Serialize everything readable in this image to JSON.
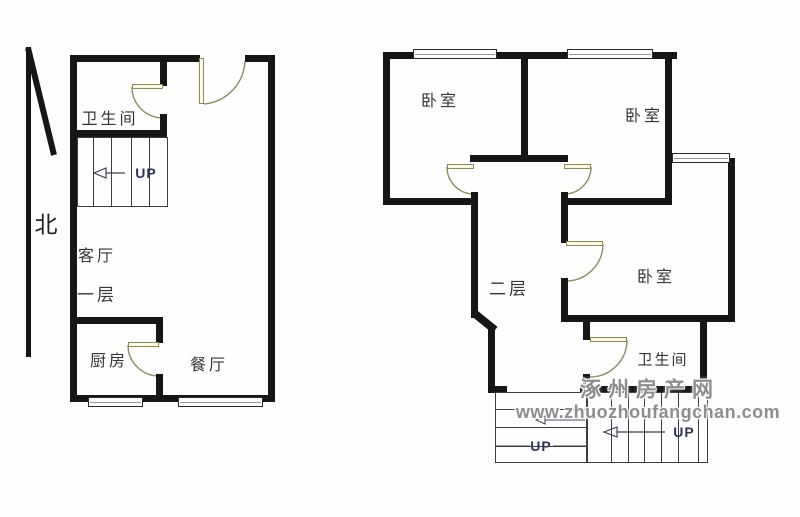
{
  "page": {
    "description": "duplex apartment floor plan"
  },
  "compass": {
    "north_label": "北"
  },
  "first_floor": {
    "floor_label": "一层",
    "rooms": {
      "bathroom": "卫生间",
      "living_room": "客厅",
      "kitchen": "厨房",
      "dining_room": "餐厅"
    },
    "stairs": {
      "up_label": "UP"
    }
  },
  "second_floor": {
    "floor_label": "二层",
    "rooms": {
      "bedroom_top_left": "卧室",
      "bedroom_top_right": "卧室",
      "bedroom_middle": "卧室",
      "bathroom": "卫生间"
    },
    "stairs_left": {
      "up_label": "UP"
    },
    "stairs_right": {
      "up_label": "UP"
    }
  },
  "watermark": {
    "site_name": "涿州房产网",
    "site_url": "www.zhuozhoufangchan.com"
  },
  "colors": {
    "wall": "#161616",
    "door_arc": "#8f8c60",
    "door_leaf_fill": "#fcf9e4",
    "stair_line": "#3d3d3d",
    "up_text": "#31355b",
    "room_text": "#353535",
    "watermark_text": "#8d8d8d"
  }
}
